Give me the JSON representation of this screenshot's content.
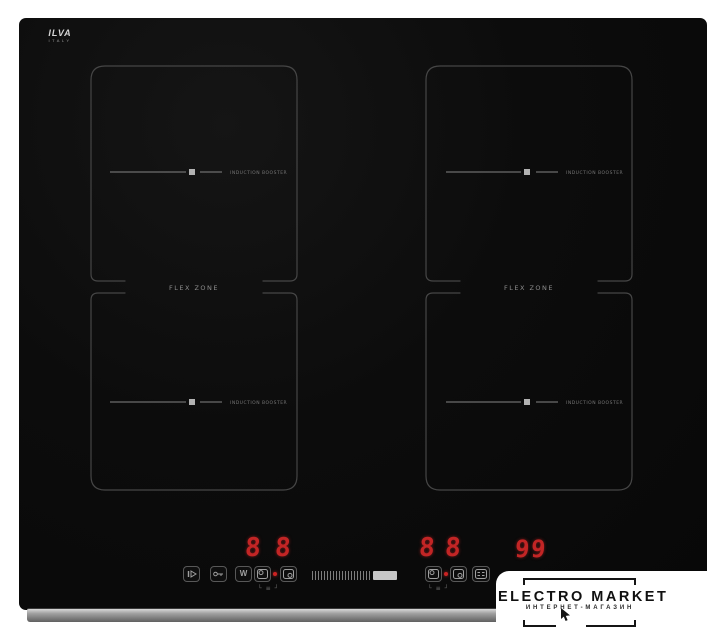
{
  "cooktop": {
    "brand": {
      "name": "ILVA",
      "country": "ITALY"
    },
    "flex_zones": {
      "left_label": "FLEX ZONE",
      "right_label": "FLEX ZONE"
    },
    "burners": [
      {
        "id": "rear-left",
        "label": "INDUCTION BOOSTER"
      },
      {
        "id": "front-left",
        "label": "INDUCTION BOOSTER"
      },
      {
        "id": "rear-right",
        "label": "INDUCTION BOOSTER"
      },
      {
        "id": "front-right",
        "label": "INDUCTION BOOSTER"
      }
    ],
    "control_panel": {
      "left_display": {
        "digits": [
          "8",
          "8"
        ]
      },
      "right_display": {
        "digits": [
          "8",
          "8"
        ]
      },
      "timer_display": {
        "digits": [
          "9",
          "9"
        ]
      },
      "buttons": [
        {
          "name": "pause"
        },
        {
          "name": "child-lock"
        },
        {
          "name": "keep-warm",
          "glyph": "W"
        },
        {
          "name": "flex-select-left-rear"
        },
        {
          "name": "flex-select-left-front"
        },
        {
          "name": "flex-select-right-rear"
        },
        {
          "name": "flex-select-right-front"
        },
        {
          "name": "timer"
        }
      ],
      "slider": {
        "ticks": 20,
        "level": "max"
      },
      "led_color": "#c22525"
    }
  },
  "watermark": {
    "title": "ELECTRO MARKET",
    "subtitle": "ИНТЕРНЕТ-МАГАЗИН"
  },
  "colors": {
    "background": "#ffffff",
    "glass": "#0b0b0b",
    "zone_outline": "#464646",
    "led": "#c22525",
    "trim": "#9c9c9c"
  }
}
